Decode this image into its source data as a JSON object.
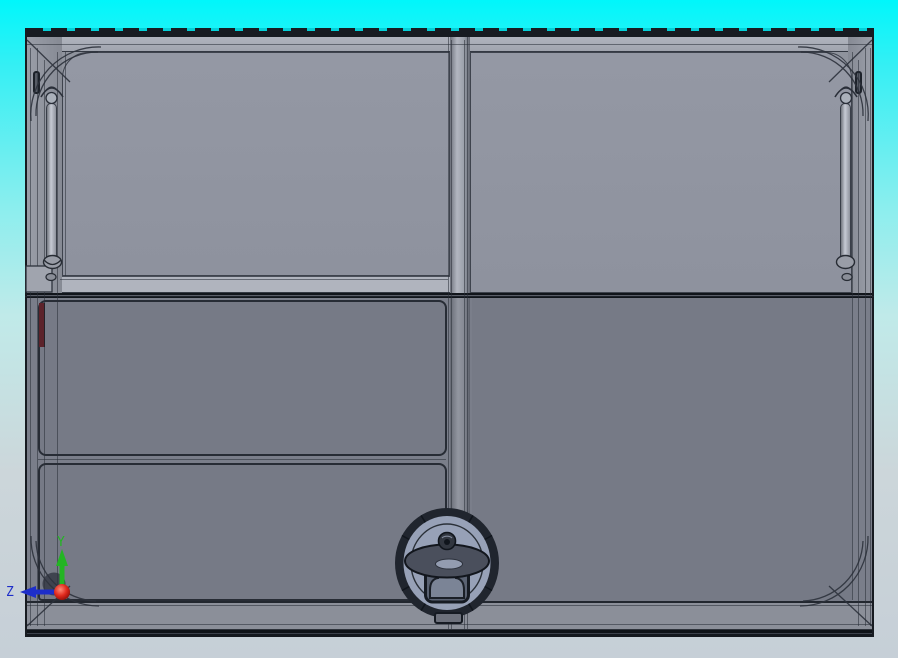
{
  "triad": {
    "labels": {
      "y": "Y",
      "z": "Z"
    },
    "axis_colors": {
      "y": "#23b523",
      "z": "#1d2ec9",
      "origin": "#cc1414",
      "hidden_x": "#6d717a"
    }
  },
  "colors": {
    "bg-top": "#00f7fb",
    "bg-mid": "#c0eae9",
    "bg-bottom": "#c6cfd7",
    "side-face": "#8f939d",
    "rail-top": "#a0a4ae",
    "rail-flap": "#b0b4be",
    "rail-bottom": "#8b8f99",
    "panel-upper": "#8e929e",
    "panel-lower": "#767a86",
    "mullion-light": "#b2b6c0",
    "edge-dark": "#14181e",
    "line-dark": "#2d323c",
    "knob-ring": "#20252e",
    "knob-face": "#97a1b7",
    "knob-cap": "#4a4f5c",
    "spring-rod-light": "#c6cad4",
    "red-strip": "#5c232b",
    "axis-y": "#23b523",
    "axis-z": "#1d2ec9",
    "origin-red": "#cc1414"
  },
  "parts": {
    "model": "enclosure-door-assembly",
    "upper_left": "upper-left-window-flap",
    "upper_right": "upper-right-window",
    "lower_left_1": "lower-left-panel-upper",
    "lower_left_2": "lower-left-panel-lower",
    "lower_right": "lower-right-door",
    "knob": "center-latch-knob",
    "springs": "gas-spring-struts",
    "strip": "red-hinge-strip"
  }
}
